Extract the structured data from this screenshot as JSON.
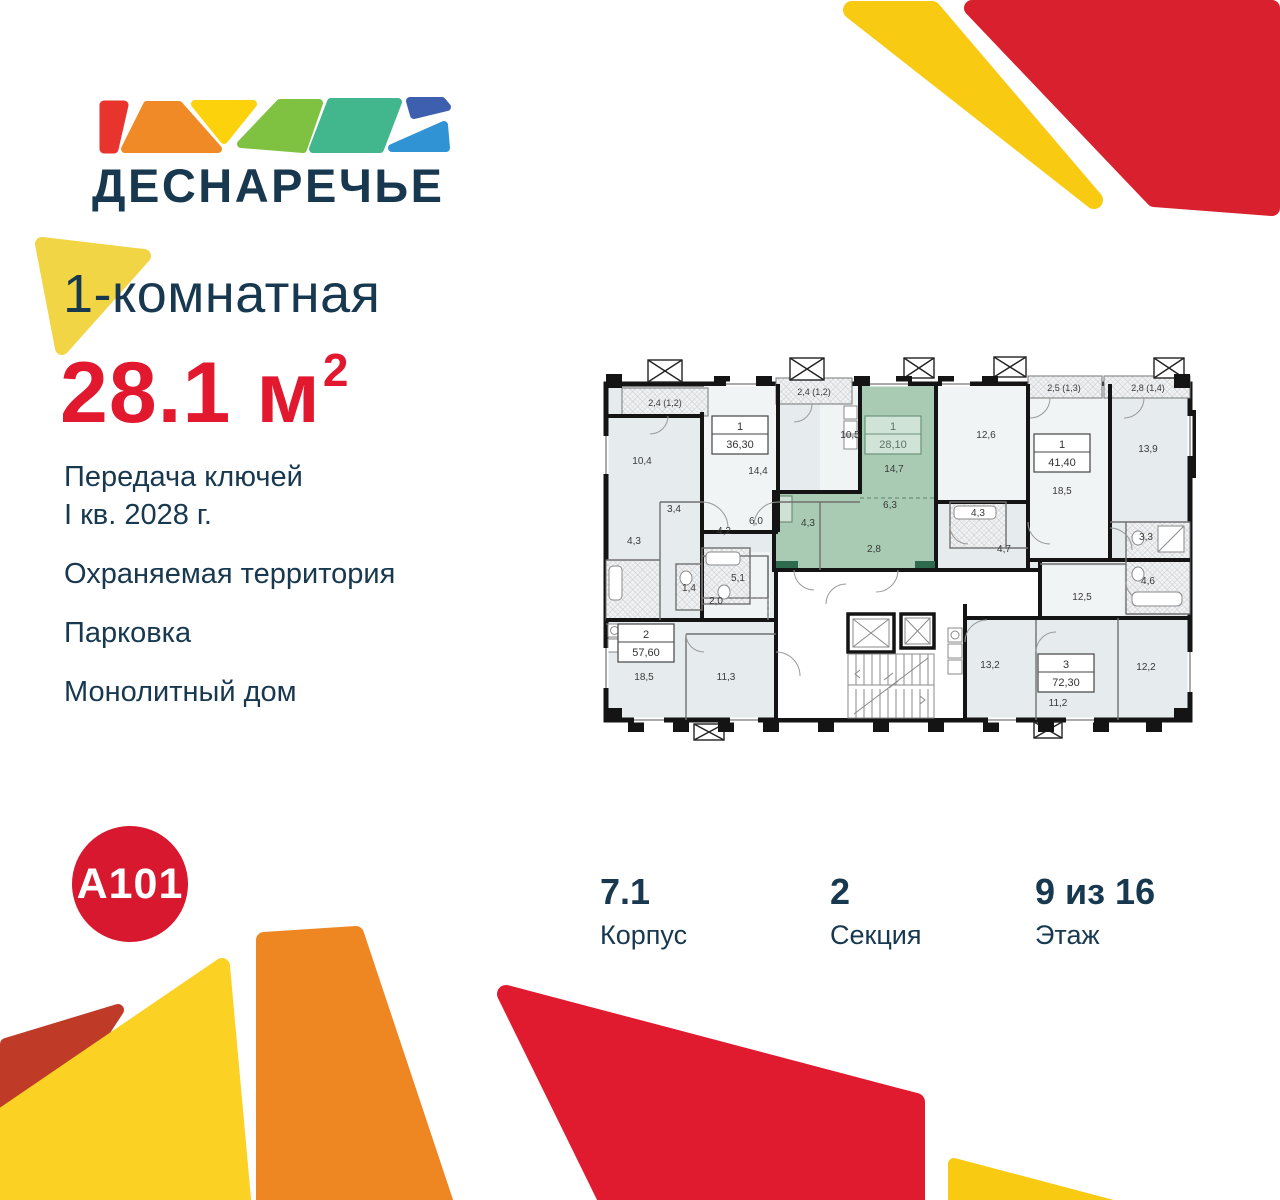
{
  "brand": {
    "logo_text": "ДЕСНАРЕЧЬЕ",
    "developer_logo": "A101"
  },
  "listing": {
    "title": "1-комнатная",
    "area": "28.1",
    "area_unit": "м",
    "area_exp": "2"
  },
  "features": [
    {
      "line1": "Передача ключей",
      "line2": "I кв. 2028 г."
    },
    {
      "line1": "Охраняемая территория",
      "line2": ""
    },
    {
      "line1": "Парковка",
      "line2": ""
    },
    {
      "line1": "Монолитный дом",
      "line2": ""
    }
  ],
  "details": {
    "building": {
      "value": "7.1",
      "label": "Корпус"
    },
    "section": {
      "value": "2",
      "label": "Секция"
    },
    "floor": {
      "value": "9 из 16",
      "label": "Этаж"
    }
  },
  "floorplan": {
    "apartments": [
      {
        "type": "1",
        "area": "36,30"
      },
      {
        "type": "1",
        "area": "28,10",
        "highlighted": "true"
      },
      {
        "type": "1",
        "area": "41,40"
      },
      {
        "type": "2",
        "area": "57,60"
      },
      {
        "type": "3",
        "area": "72,30"
      }
    ],
    "balconies": [
      "2,4 (1,2)",
      "2,4 (1,2)",
      "2,5 (1,3)",
      "2,8 (1,4)"
    ],
    "rooms": [
      "10,4",
      "14,4",
      "10,5",
      "14,7",
      "12,6",
      "18,5",
      "13,9",
      "3,4",
      "4,3",
      "4,2",
      "6,0",
      "4,3",
      "6,3",
      "2,8",
      "4,3",
      "4,7",
      "3,3",
      "4,6",
      "1,4",
      "5,1",
      "2,0",
      "18,5",
      "11,3",
      "12,5",
      "13,2",
      "11,2",
      "12,2"
    ]
  },
  "colors": {
    "navy": "#17384f",
    "accent_red": "#e2182f",
    "a101_red": "#d7182f",
    "highlight_green": "#a9cbb3",
    "decor_yellow": "#f8ca12",
    "decor_orange": "#ee8722",
    "decor_red": "#d8202f",
    "decor_brick": "#c03a28"
  }
}
